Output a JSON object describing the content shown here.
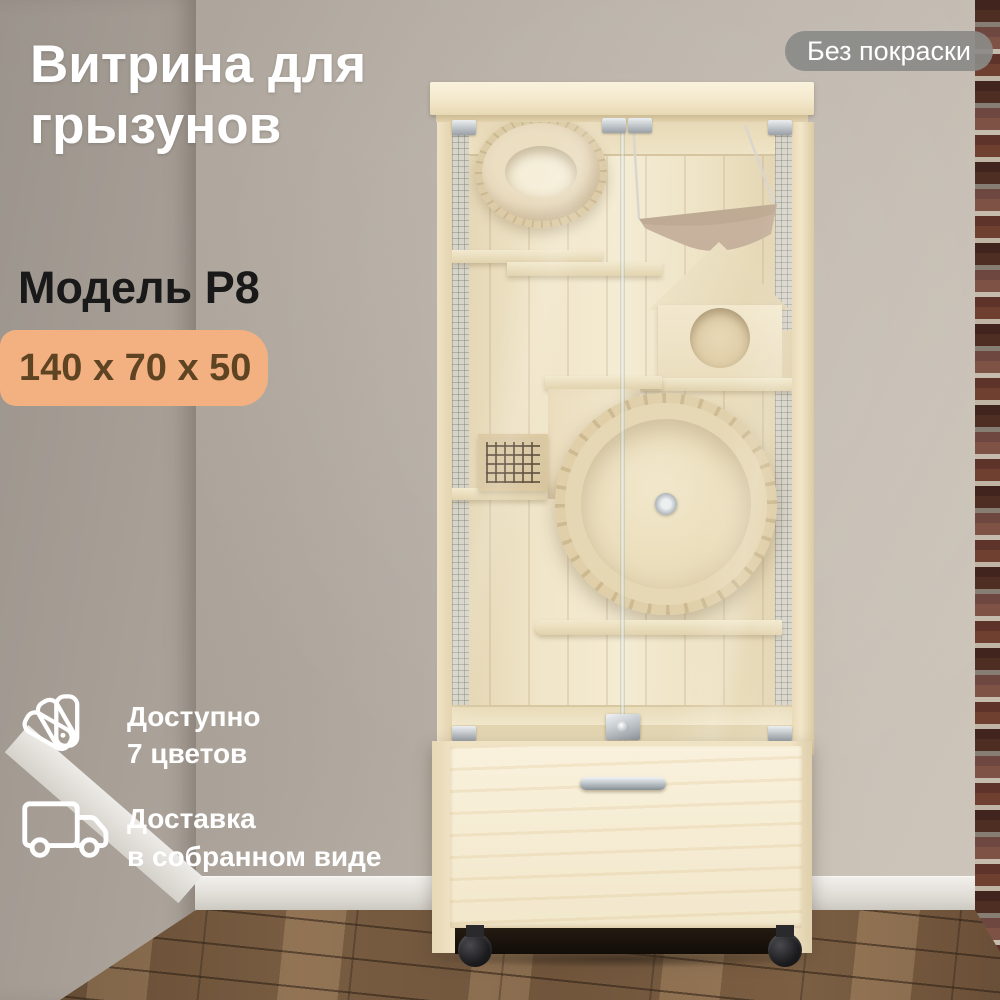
{
  "header": {
    "title_line1": "Витрина для",
    "title_line2": "грызунов",
    "finish_badge": "Без покраски"
  },
  "product": {
    "model": "Модель Р8",
    "dimensions": "140 x 70 x 50"
  },
  "features": [
    {
      "icon": "color-swatches-icon",
      "line1": "Доступно",
      "line2": "7 цветов"
    },
    {
      "icon": "delivery-truck-icon",
      "line1": "Доставка",
      "line2": "в собранном виде"
    }
  ],
  "colors": {
    "dimensions_badge_bg": "#f3b080",
    "dimensions_badge_text": "#5e4423",
    "finish_badge_bg": "#8a8a87",
    "overlay_text_light": "#ffffff",
    "overlay_text_dark": "#191919",
    "cabinet_wood": "#f2e6c9",
    "brick_wall": "#61352a",
    "floor_wood": "#7a5e44"
  }
}
